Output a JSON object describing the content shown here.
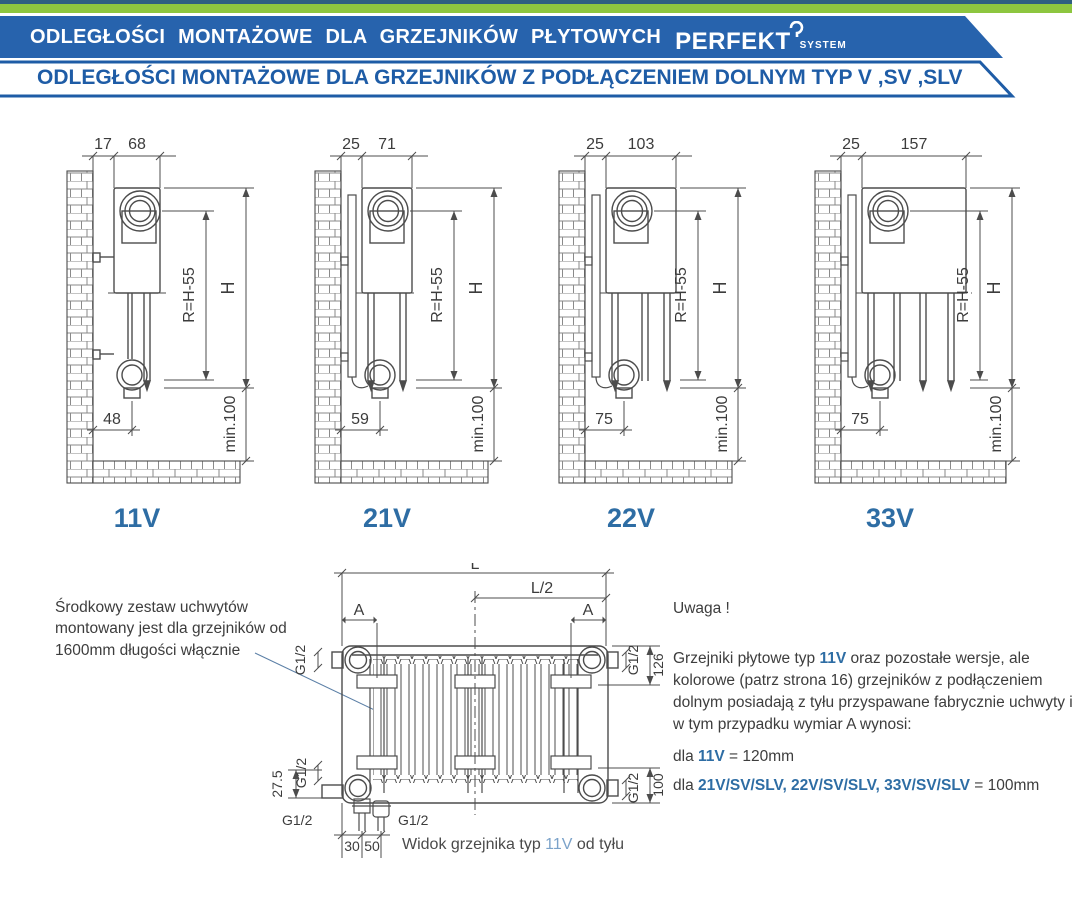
{
  "header": {
    "title": "ODLEGŁOŚCI MONTAŻOWE DLA GRZEJNIKÓW PŁYTOWYCH",
    "brand": "PERFEKT",
    "brand_sub": "SYSTEM",
    "subtitle": "ODLEGŁOŚCI MONTAŻOWE DLA GRZEJNIKÓW Z PODŁĄCZENIEM DOLNYM TYP V ,SV ,SLV",
    "colors": {
      "banner_blue": "#2763ad",
      "green": "#8dc63f",
      "text_blue": "#1e5ca6",
      "accent_blue": "#2e6da4"
    }
  },
  "diagrams": [
    {
      "label": "11V",
      "dim_wall": "17",
      "dim_depth": "68",
      "dim_bottom": "48",
      "dim_r": "R=H-55",
      "dim_h": "H",
      "dim_min": "min.100"
    },
    {
      "label": "21V",
      "dim_wall": "25",
      "dim_depth": "71",
      "dim_bottom": "59",
      "dim_r": "R=H-55",
      "dim_h": "H",
      "dim_min": "min.100"
    },
    {
      "label": "22V",
      "dim_wall": "25",
      "dim_depth": "103",
      "dim_bottom": "75",
      "dim_r": "R=H-55",
      "dim_h": "H",
      "dim_min": "min.100"
    },
    {
      "label": "33V",
      "dim_wall": "25",
      "dim_depth": "157",
      "dim_bottom": "75",
      "dim_r": "R=H-55",
      "dim_h": "H",
      "dim_min": "min.100"
    }
  ],
  "rear": {
    "L": "L",
    "L2": "L/2",
    "A": "A",
    "g12": "G1/2",
    "d126": "126",
    "d100": "100",
    "d275": "27.5",
    "d30": "30",
    "d50": "50"
  },
  "caption": {
    "prefix": "Widok grzejnika typ ",
    "type": "11V",
    "suffix": " od tyłu"
  },
  "notes": {
    "left_note": "Środkowy zestaw uchwytów montowany jest dla grzejników od 1600mm długości włącznie",
    "warning_title": "Uwaga !",
    "body_1": "Grzejniki płytowe typ ",
    "body_type": "11V",
    "body_2": " oraz pozostałe wersje, ale kolorowe (patrz strona 16) grzejników z podłączeniem dolnym posiadają z tyłu przyspawane fabrycznie uchwyty i w tym przypadku wymiar A wynosi:",
    "line_a_prefix": "dla ",
    "line_a_type": "11V",
    "line_a_value": " = 120mm",
    "line_b_prefix": "dla ",
    "line_b_types": "21V/SV/SLV, 22V/SV/SLV, 33V/SV/SLV",
    "line_b_value": " = 100mm"
  }
}
